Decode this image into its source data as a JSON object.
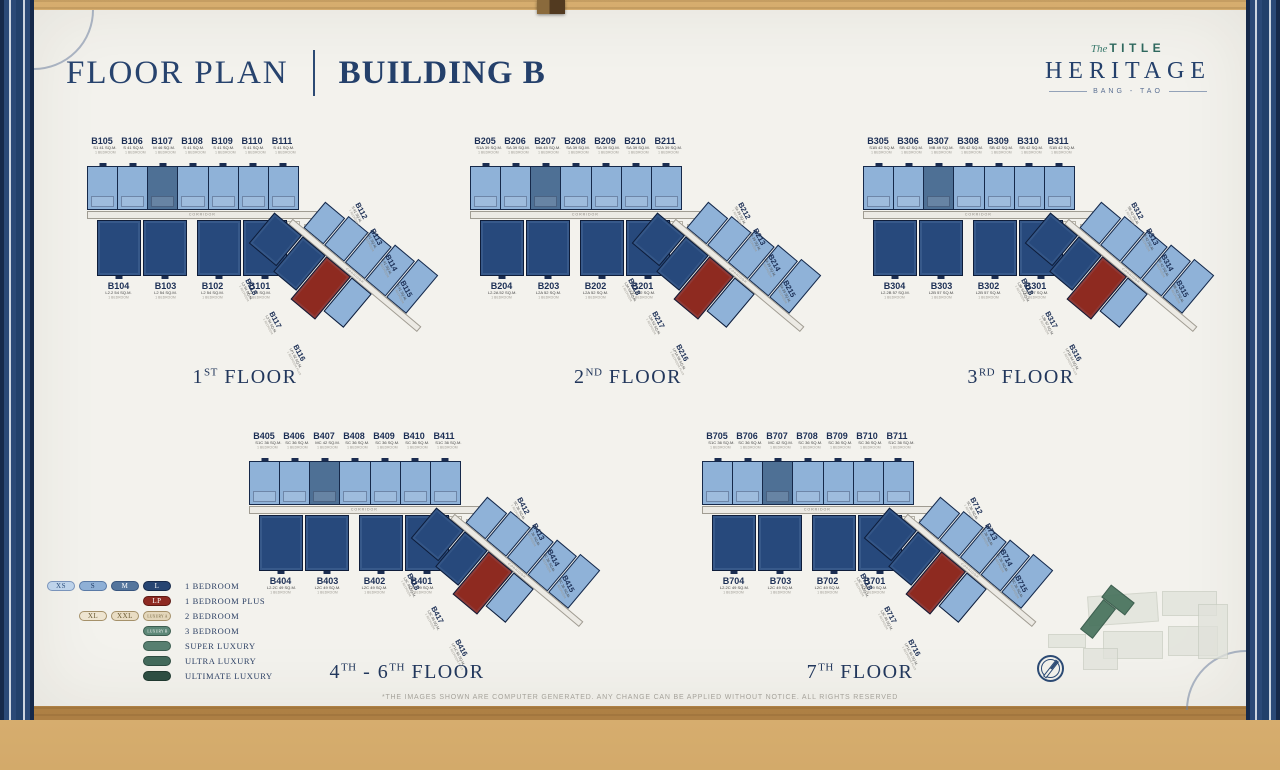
{
  "header": {
    "title": "FLOOR PLAN",
    "subtitle": "BUILDING B"
  },
  "logo": {
    "script": "The",
    "brand": "TITLE",
    "name": "HERITAGE",
    "location": "BANG - TAO"
  },
  "corridor_label": "CORRIDOR",
  "colors": {
    "unit_light": "#8fb2d8",
    "unit_mid": "#4e7095",
    "unit_dark": "#27497c",
    "unit_red": "#8e2a20",
    "navy": "#24406b",
    "teal": "#2f685e",
    "paper": "#f3f2ed",
    "wood": "#c49a58"
  },
  "floors": [
    {
      "caption_parts": [
        {
          "text": "1"
        },
        {
          "sup": "ST"
        },
        {
          "text": " FLOOR"
        }
      ],
      "top_units": [
        {
          "id": "B105",
          "size": "S1 41 SQ.M.",
          "type": "1 BEDROOM"
        },
        {
          "id": "B106",
          "size": "S 41 SQ.M.",
          "type": "1 BEDROOM"
        },
        {
          "id": "B107",
          "size": "M 46 SQ.M.",
          "type": "1 BEDROOM"
        },
        {
          "id": "B108",
          "size": "S 41 SQ.M.",
          "type": "1 BEDROOM"
        },
        {
          "id": "B109",
          "size": "S 41 SQ.M.",
          "type": "1 BEDROOM"
        },
        {
          "id": "B110",
          "size": "S 41 SQ.M.",
          "type": "1 BEDROOM"
        },
        {
          "id": "B111",
          "size": "S 41 SQ.M.",
          "type": "1 BEDROOM"
        }
      ],
      "bottom_units": [
        {
          "id": "B104",
          "size": "L2.2 54 SQ.M.",
          "type": "1 BEDROOM"
        },
        {
          "id": "B103",
          "size": "L2 54 SQ.M.",
          "type": "1 BEDROOM"
        },
        {
          "id": "B102",
          "size": "L2 54 SQ.M.",
          "type": "1 BEDROOM"
        },
        {
          "id": "B101",
          "size": "L2 54 SQ.M.",
          "type": "1 BEDROOM"
        }
      ],
      "wing_right_units": [
        {
          "id": "B112",
          "size": "S 41 SQ.M.",
          "type": "1 BEDROOM"
        },
        {
          "id": "B113",
          "size": "S 41 SQ.M.",
          "type": "1 BEDROOM"
        },
        {
          "id": "B114",
          "size": "S 41 SQ.M.",
          "type": "1 BEDROOM"
        },
        {
          "id": "B115",
          "size": "S 41 SQ.M.",
          "type": "1 BEDROOM"
        }
      ],
      "wing_left_units": [
        {
          "id": "B118",
          "size": "L2 54 SQ.M.",
          "type": "1 BEDROOM"
        },
        {
          "id": "B117",
          "size": "L2 54 SQ.M.",
          "type": "1 BEDROOM"
        },
        {
          "id": "B116",
          "size": "LP1 62 SQ.M.",
          "type": "1 BEDROOM PLUS",
          "red": true
        }
      ]
    },
    {
      "caption_parts": [
        {
          "text": "2"
        },
        {
          "sup": "ND"
        },
        {
          "text": " FLOOR"
        }
      ],
      "top_units": [
        {
          "id": "B205",
          "size": "S1A 39 SQ.M.",
          "type": "1 BEDROOM"
        },
        {
          "id": "B206",
          "size": "SA 39 SQ.M.",
          "type": "1 BEDROOM"
        },
        {
          "id": "B207",
          "size": "MA 45 SQ.M.",
          "type": "1 BEDROOM"
        },
        {
          "id": "B208",
          "size": "SA 39 SQ.M.",
          "type": "1 BEDROOM"
        },
        {
          "id": "B209",
          "size": "SA 39 SQ.M.",
          "type": "1 BEDROOM"
        },
        {
          "id": "B210",
          "size": "SA 39 SQ.M.",
          "type": "1 BEDROOM"
        },
        {
          "id": "B211",
          "size": "S2A 39 SQ.M.",
          "type": "1 BEDROOM"
        }
      ],
      "bottom_units": [
        {
          "id": "B204",
          "size": "L2.2A 52 SQ.M.",
          "type": "1 BEDROOM"
        },
        {
          "id": "B203",
          "size": "L2A 52 SQ.M.",
          "type": "1 BEDROOM"
        },
        {
          "id": "B202",
          "size": "L2A 52 SQ.M.",
          "type": "1 BEDROOM"
        },
        {
          "id": "B201",
          "size": "L2A 52 SQ.M.",
          "type": "1 BEDROOM"
        }
      ],
      "wing_right_units": [
        {
          "id": "B212",
          "size": "SA 39 SQ.M.",
          "type": "1 BEDROOM"
        },
        {
          "id": "B213",
          "size": "SA 39 SQ.M.",
          "type": "1 BEDROOM"
        },
        {
          "id": "B214",
          "size": "SA 39 SQ.M.",
          "type": "1 BEDROOM"
        },
        {
          "id": "B215",
          "size": "SA 39 SQ.M.",
          "type": "1 BEDROOM"
        }
      ],
      "wing_left_units": [
        {
          "id": "B218",
          "size": "L2A 52 SQ.M.",
          "type": "1 BEDROOM"
        },
        {
          "id": "B217",
          "size": "L2A 52 SQ.M.",
          "type": "1 BEDROOM"
        },
        {
          "id": "B216",
          "size": "LP1A 59 SQ.M.",
          "type": "1 BEDROOM PLUS",
          "red": true
        }
      ]
    },
    {
      "caption_parts": [
        {
          "text": "3"
        },
        {
          "sup": "RD"
        },
        {
          "text": " FLOOR"
        }
      ],
      "top_units": [
        {
          "id": "B305",
          "size": "S1B 42 SQ.M.",
          "type": "1 BEDROOM"
        },
        {
          "id": "B306",
          "size": "SB 42 SQ.M.",
          "type": "1 BEDROOM"
        },
        {
          "id": "B307",
          "size": "MB 49 SQ.M.",
          "type": "1 BEDROOM"
        },
        {
          "id": "B308",
          "size": "SB 42 SQ.M.",
          "type": "1 BEDROOM"
        },
        {
          "id": "B309",
          "size": "SB 42 SQ.M.",
          "type": "1 BEDROOM"
        },
        {
          "id": "B310",
          "size": "SB 42 SQ.M.",
          "type": "1 BEDROOM"
        },
        {
          "id": "B311",
          "size": "S1B 42 SQ.M.",
          "type": "1 BEDROOM"
        }
      ],
      "bottom_units": [
        {
          "id": "B304",
          "size": "L2.2B 57 SQ.M.",
          "type": "1 BEDROOM"
        },
        {
          "id": "B303",
          "size": "L2B 57 SQ.M.",
          "type": "1 BEDROOM"
        },
        {
          "id": "B302",
          "size": "L2B 57 SQ.M.",
          "type": "1 BEDROOM"
        },
        {
          "id": "B301",
          "size": "L2B 57 SQ.M.",
          "type": "1 BEDROOM"
        }
      ],
      "wing_right_units": [
        {
          "id": "B312",
          "size": "SB 42 SQ.M.",
          "type": "1 BEDROOM"
        },
        {
          "id": "B313",
          "size": "SB 42 SQ.M.",
          "type": "1 BEDROOM"
        },
        {
          "id": "B314",
          "size": "SB 42 SQ.M.",
          "type": "1 BEDROOM"
        },
        {
          "id": "B315",
          "size": "SB 42 SQ.M.",
          "type": "1 BEDROOM"
        }
      ],
      "wing_left_units": [
        {
          "id": "B318",
          "size": "L2B 57 SQ.M.",
          "type": "1 BEDROOM"
        },
        {
          "id": "B317",
          "size": "L2B 57 SQ.M.",
          "type": "1 BEDROOM"
        },
        {
          "id": "B316",
          "size": "LP1B 64 SQ.M.",
          "type": "1 BEDROOM PLUS",
          "red": true
        }
      ]
    },
    {
      "caption_parts": [
        {
          "text": "4"
        },
        {
          "sup": "TH"
        },
        {
          "text": " - 6"
        },
        {
          "sup": "TH"
        },
        {
          "text": " FLOOR"
        }
      ],
      "top_units": [
        {
          "id": "B405",
          "size": "S1C 36 SQ.M.",
          "type": "1 BEDROOM"
        },
        {
          "id": "B406",
          "size": "SC 36 SQ.M.",
          "type": "1 BEDROOM"
        },
        {
          "id": "B407",
          "size": "MC 42 SQ.M.",
          "type": "1 BEDROOM"
        },
        {
          "id": "B408",
          "size": "SC 36 SQ.M.",
          "type": "1 BEDROOM"
        },
        {
          "id": "B409",
          "size": "SC 36 SQ.M.",
          "type": "1 BEDROOM"
        },
        {
          "id": "B410",
          "size": "SC 36 SQ.M.",
          "type": "1 BEDROOM"
        },
        {
          "id": "B411",
          "size": "S1C 36 SQ.M.",
          "type": "1 BEDROOM"
        }
      ],
      "bottom_units": [
        {
          "id": "B404",
          "size": "L2.2C 49 SQ.M.",
          "type": "1 BEDROOM"
        },
        {
          "id": "B403",
          "size": "L2C 49 SQ.M.",
          "type": "1 BEDROOM"
        },
        {
          "id": "B402",
          "size": "L2C 49 SQ.M.",
          "type": "1 BEDROOM"
        },
        {
          "id": "B401",
          "size": "L2C 49 SQ.M.",
          "type": "1 BEDROOM"
        }
      ],
      "wing_right_units": [
        {
          "id": "B412",
          "size": "SC 36 SQ.M.",
          "type": "1 BEDROOM"
        },
        {
          "id": "B413",
          "size": "SC 36 SQ.M.",
          "type": "1 BEDROOM"
        },
        {
          "id": "B414",
          "size": "SC 36 SQ.M.",
          "type": "1 BEDROOM"
        },
        {
          "id": "B415",
          "size": "SC 36 SQ.M.",
          "type": "1 BEDROOM"
        }
      ],
      "wing_left_units": [
        {
          "id": "B418",
          "size": "L2C 49 SQ.M.",
          "type": "1 BEDROOM"
        },
        {
          "id": "B417",
          "size": "L2C 49 SQ.M.",
          "type": "1 BEDROOM"
        },
        {
          "id": "B416",
          "size": "LP1C 56 SQ.M.",
          "type": "1 BEDROOM PLUS",
          "red": true
        }
      ]
    },
    {
      "caption_parts": [
        {
          "text": "7"
        },
        {
          "sup": "TH"
        },
        {
          "text": " FLOOR"
        }
      ],
      "top_units": [
        {
          "id": "B705",
          "size": "S1C 36 SQ.M.",
          "type": "1 BEDROOM"
        },
        {
          "id": "B706",
          "size": "SC 36 SQ.M.",
          "type": "1 BEDROOM"
        },
        {
          "id": "B707",
          "size": "MC 42 SQ.M.",
          "type": "1 BEDROOM"
        },
        {
          "id": "B708",
          "size": "SC 36 SQ.M.",
          "type": "1 BEDROOM"
        },
        {
          "id": "B709",
          "size": "SC 36 SQ.M.",
          "type": "1 BEDROOM"
        },
        {
          "id": "B710",
          "size": "SC 36 SQ.M.",
          "type": "1 BEDROOM"
        },
        {
          "id": "B711",
          "size": "S1C 36 SQ.M.",
          "type": "1 BEDROOM"
        }
      ],
      "bottom_units": [
        {
          "id": "B704",
          "size": "L2.2C 49 SQ.M.",
          "type": "1 BEDROOM"
        },
        {
          "id": "B703",
          "size": "L2C 49 SQ.M.",
          "type": "1 BEDROOM"
        },
        {
          "id": "B702",
          "size": "L2C 49 SQ.M.",
          "type": "1 BEDROOM"
        },
        {
          "id": "B701",
          "size": "L2C 49 SQ.M.",
          "type": "1 BEDROOM"
        }
      ],
      "wing_right_units": [
        {
          "id": "B712",
          "size": "SC 36 SQ.M.",
          "type": "1 BEDROOM"
        },
        {
          "id": "B713",
          "size": "SC 36 SQ.M.",
          "type": "1 BEDROOM"
        },
        {
          "id": "B714",
          "size": "SC 36 SQ.M.",
          "type": "1 BEDROOM"
        },
        {
          "id": "B715",
          "size": "SC 36 SQ.M.",
          "type": "1 BEDROOM"
        }
      ],
      "wing_left_units": [
        {
          "id": "B718",
          "size": "L2C 49 SQ.M.",
          "type": "1 BEDROOM"
        },
        {
          "id": "B717",
          "size": "L2C 49 SQ.M.",
          "type": "1 BEDROOM"
        },
        {
          "id": "B716",
          "size": "LP1C 56 SQ.M.",
          "type": "1 BEDROOM PLUS",
          "red": true
        }
      ]
    }
  ],
  "legend": {
    "rows": [
      {
        "text": "1 BEDROOM",
        "pills": [
          {
            "label": "XS",
            "bg": "#bed3ea",
            "border": "#7a94bb",
            "text_color": "#2d4f7c"
          },
          {
            "label": "S",
            "bg": "#8fb0d6",
            "border": "#5a7aa6",
            "text_color": "#1f3a63"
          },
          {
            "label": "M",
            "bg": "#54759c",
            "border": "#37557e",
            "text_color": "#ffffff"
          },
          {
            "label": "L",
            "bg": "#274572",
            "border": "#16294a",
            "text_color": "#ffffff"
          }
        ]
      },
      {
        "text": "1 BEDROOM PLUS",
        "pills": [
          {
            "label": "LP",
            "bg": "#8e2a22",
            "border": "#5f1a14",
            "text_color": "#ffffff"
          }
        ]
      },
      {
        "text": "2 BEDROOM",
        "pills": [
          {
            "label": "XL",
            "bg": "#eee5d1",
            "border": "#a5916a",
            "text_color": "#6b5b33"
          },
          {
            "label": "XXL",
            "bg": "#e9ddc4",
            "border": "#a5916a",
            "text_color": "#6b5b33"
          },
          {
            "label": "LUXURY A",
            "bg": "#e3d6ba",
            "border": "#a5916a",
            "text_color": "#6b5b33",
            "small": true
          }
        ]
      },
      {
        "text": "3 BEDROOM",
        "pills": [
          {
            "label": "LUXURY B",
            "bg": "#5d8878",
            "border": "#3c5d50",
            "text_color": "#ffffff",
            "small": true
          }
        ]
      },
      {
        "text": "SUPER LUXURY",
        "pills": [
          {
            "label": "",
            "bg": "#577f70",
            "border": "#3c5d50",
            "text_color": "#ffffff"
          }
        ]
      },
      {
        "text": "ULTRA LUXURY",
        "pills": [
          {
            "label": "",
            "bg": "#436a5b",
            "border": "#2e4c41",
            "text_color": "#ffffff"
          }
        ]
      },
      {
        "text": "ULTIMATE LUXURY",
        "pills": [
          {
            "label": "",
            "bg": "#2e4e42",
            "border": "#1f382f",
            "text_color": "#ffffff"
          }
        ]
      }
    ]
  },
  "footer": {
    "disclaimer": "*THE IMAGES SHOWN ARE COMPUTER GENERATED. ANY CHANGE CAN BE APPLIED WITHOUT NOTICE. ALL RIGHTS RESERVED"
  }
}
